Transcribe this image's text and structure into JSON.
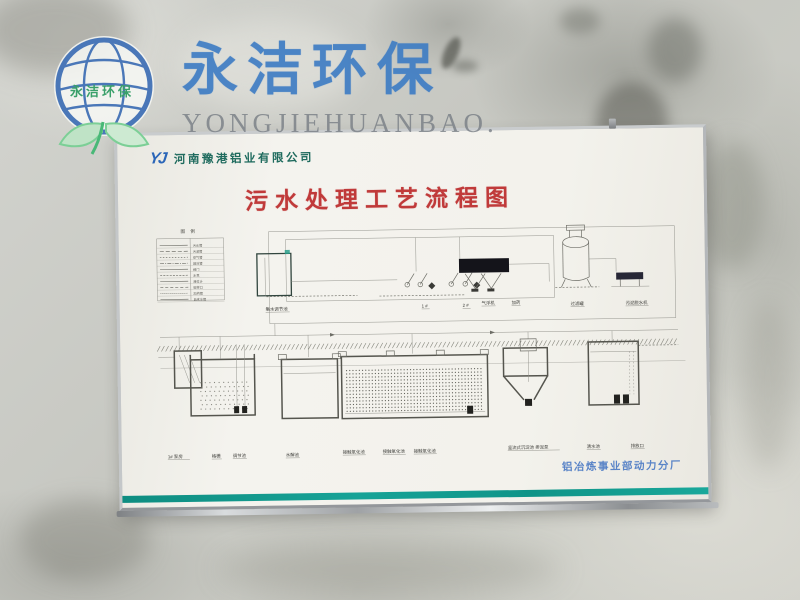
{
  "watermark": {
    "brand_cn": "永洁环保",
    "brand_en": "YONGJIEHUANBAO.",
    "logo_inner": "永洁环保"
  },
  "poster": {
    "company": {
      "logo": "YJ",
      "name": "河南豫港铝业有限公司"
    },
    "title": "污水处理工艺流程图",
    "footer": "铝冶炼事业部动力分厂",
    "legend": {
      "title": "图 例",
      "rows": [
        "污水管",
        "污泥管",
        "空气管",
        "回流管",
        "阀门",
        "水泵",
        "液位计",
        "取样口",
        "加药管",
        "自来水管"
      ]
    },
    "diagram": {
      "upper_labels": [
        "集水调节池",
        "1 #",
        "2 #",
        "气浮机",
        "加药",
        "过滤罐",
        "污泥脱水机"
      ],
      "lower_labels": [
        "1# 泵房",
        "格栅",
        "调节池",
        "水解池",
        "接触氧化池",
        "接触氧化池",
        "接触氧化池",
        "竖流式沉淀池 排泥泵",
        "清水池",
        "排放口"
      ]
    },
    "colors": {
      "title_red": "#c03a3a",
      "footer_blue": "#4a79c4",
      "brand_blue": "#3f7dc4",
      "company_teal": "#1f6b5e",
      "stripe_teal": "#0f9488",
      "leaf_green": "#7ccf96"
    }
  }
}
